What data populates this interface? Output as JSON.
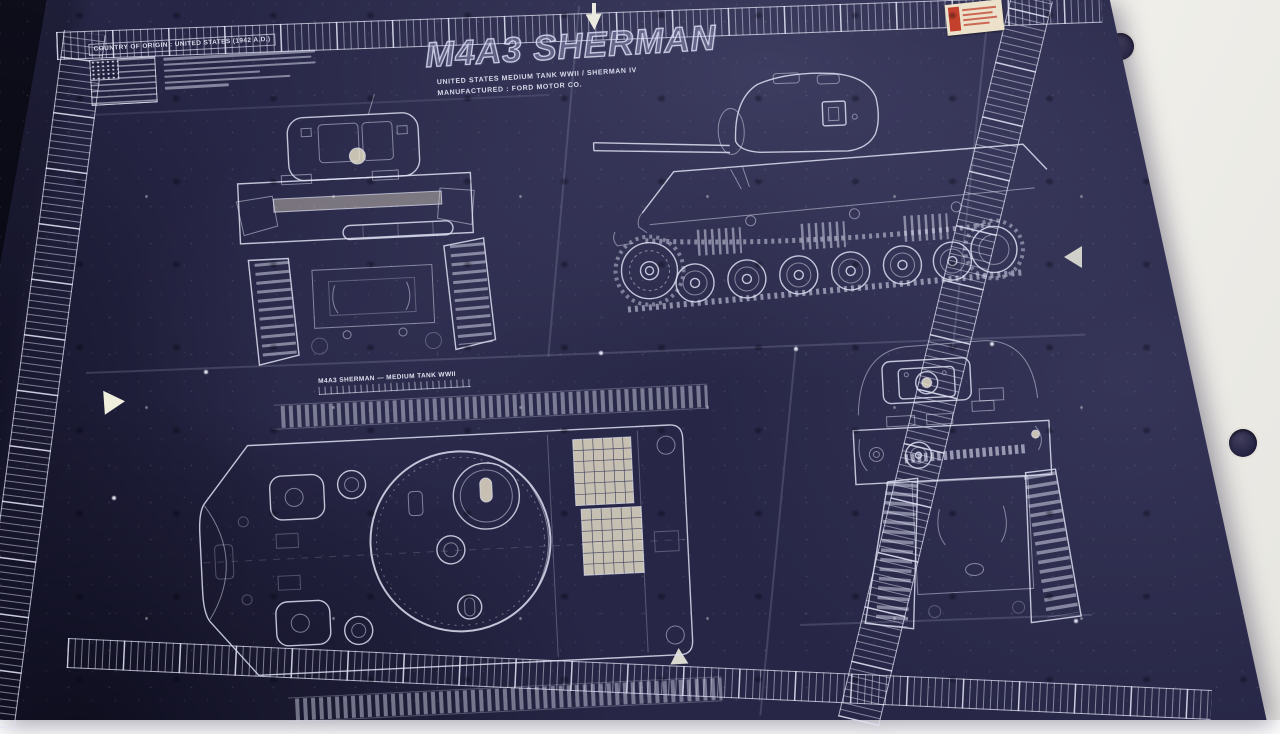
{
  "colors": {
    "paper": "#f4f3ee",
    "sheet": "#272646",
    "sheet_dark": "#10101f",
    "line": "#dde0f2",
    "cream": "#efe7cd",
    "stamp_red": "#c2402c",
    "hole": "#312f4c"
  },
  "title_block": {
    "title": "M4A3 SHERMAN",
    "subtitle1": "UNITED STATES MEDIUM TANK WWII / SHERMAN IV",
    "subtitle2": "MANUFACTURED : FORD MOTOR CO."
  },
  "info_box": {
    "heading": "COUNTRY OF ORIGIN : UNITED STATES (1942 A.D.)"
  },
  "plan_view": {
    "caption": "M4A3 SHERMAN — MEDIUM TANK WWII"
  }
}
